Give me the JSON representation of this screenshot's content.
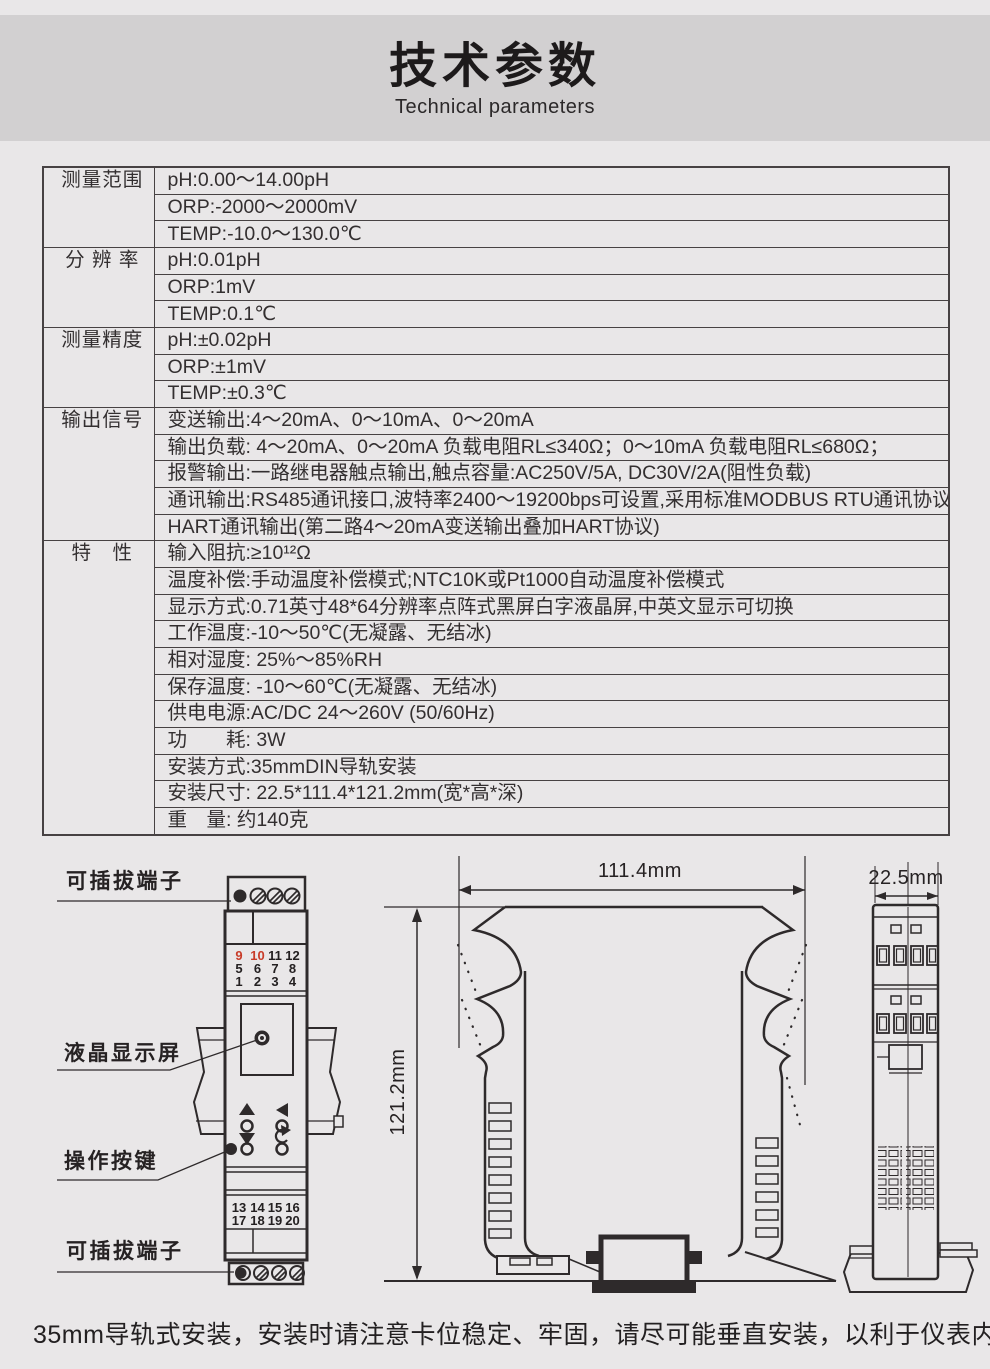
{
  "header": {
    "title": "技术参数",
    "subtitle": "Technical parameters"
  },
  "table": {
    "sections": [
      {
        "label": "测量范围",
        "rows": [
          "pH:0.00～14.00pH",
          "ORP:-2000～2000mV",
          "TEMP:-10.0～130.0℃"
        ]
      },
      {
        "label": "分 辨 率",
        "rows": [
          "pH:0.01pH",
          "ORP:1mV",
          "TEMP:0.1℃"
        ]
      },
      {
        "label": "测量精度",
        "rows": [
          "pH:±0.02pH",
          "ORP:±1mV",
          "TEMP:±0.3℃"
        ]
      },
      {
        "label": "输出信号",
        "rows": [
          "变送输出:4～20mA、0～10mA、0～20mA",
          "输出负载: 4～20mA、0～20mA 负载电阻RL≤340Ω；0～10mA 负载电阻RL≤680Ω；",
          "报警输出:一路继电器触点输出,触点容量:AC250V/5A, DC30V/2A(阻性负载)",
          "通讯输出:RS485通讯接口,波特率2400～19200bps可设置,采用标准MODBUS RTU通讯协议",
          "HART通讯输出(第二路4～20mA变送输出叠加HART协议)"
        ]
      },
      {
        "label": "特　性",
        "rows": [
          "输入阻抗:≥10¹²Ω",
          "温度补偿:手动温度补偿模式;NTC10K或Pt1000自动温度补偿模式",
          "显示方式:0.71英寸48*64分辨率点阵式黑屏白字液晶屏,中英文显示可切换",
          "工作温度:-10～50℃(无凝露、无结冰)",
          "相对湿度: 25%～85%RH",
          "保存温度: -10～60℃(无凝露、无结冰)",
          "供电电源:AC/DC 24～260V (50/60Hz)",
          "功　　耗: 3W",
          "安装方式:35mmDIN导轨安装",
          "安装尺寸: 22.5*111.4*121.2mm(宽*高*深)",
          "重　量: 约140克"
        ]
      }
    ]
  },
  "diagram": {
    "labels": {
      "terminal_top": "可插拔端子",
      "lcd": "液晶显示屏",
      "keys": "操作按键",
      "terminal_bottom": "可插拔端子"
    },
    "terminals_top": [
      "9",
      "10",
      "11",
      "12",
      "5",
      "6",
      "7",
      "8",
      "1",
      "2",
      "3",
      "4"
    ],
    "terminals_bottom": [
      "13",
      "14",
      "15",
      "16",
      "17",
      "18",
      "19",
      "20"
    ],
    "dims": {
      "width": "111.4mm",
      "height": "121.2mm",
      "depth": "22.5mm"
    },
    "colors": {
      "red_terminal": "#c83b28",
      "ink": "#2e2a2b"
    }
  },
  "footer": {
    "note": "35mm导轨式安装，安装时请注意卡位稳定、牢固，请尽可能垂直安装，以利于仪表内部热量散发。"
  }
}
